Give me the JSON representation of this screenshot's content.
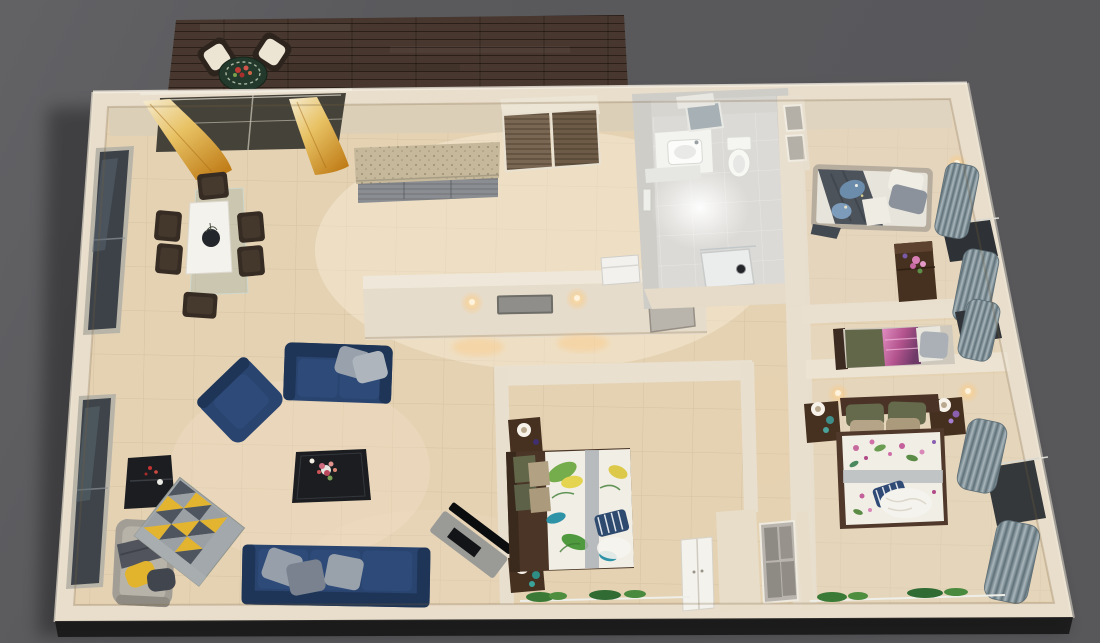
{
  "scene": {
    "description": "Photorealistic 3D rendered top-down floor plan (dollhouse view) of a furnished apartment on a dark gray backdrop",
    "view": "top-down 3D render, slight perspective",
    "rooms": [
      {
        "id": "balcony",
        "label": "Balcony deck",
        "items": [
          "dark wood plank decking",
          "round bistro table with red flowers",
          "two rattan chairs with white cushions"
        ]
      },
      {
        "id": "living-dining",
        "label": "Open living and dining room",
        "items": [
          "glass dining table with white marble runner",
          "six dark dining chairs",
          "navy armchair",
          "navy loveseat with two gray pillows",
          "navy three-seat sofa with three gray pillows",
          "black coffee table with flower bouquet",
          "black console table",
          "gray chaise lounge with yellow and charcoal pillows",
          "geometric triangle rug in gray, charcoal and yellow",
          "angled TV unit with flat-screen TV",
          "amber curtains on balcony sliding door",
          "two tall windows on left wall"
        ]
      },
      {
        "id": "kitchen",
        "label": "Kitchenette",
        "items": [
          "granite countertop with gray cabinet fronts",
          "built-in wardrobe with wood sliding doors",
          "white fridge"
        ]
      },
      {
        "id": "hallway",
        "label": "Hallway",
        "items": [
          "divider wall with two lit sconces",
          "framed picture",
          "gray wall panel"
        ]
      },
      {
        "id": "bathroom",
        "label": "Bathroom",
        "items": [
          "vanity with basin and tilted mirror",
          "toilet",
          "shower tray with drain",
          "white-gray tiles",
          "ceiling light glow"
        ]
      },
      {
        "id": "bedroom-top-right",
        "label": "Bedroom (top right)",
        "items": [
          "single bed with charcoal throw and blue floral duvet",
          "white and gray pillows",
          "dark wood dresser with pink flowers",
          "wall lamp",
          "gray drape curtains and window"
        ]
      },
      {
        "id": "bedroom-middle-right",
        "label": "Bedroom (middle right)",
        "items": [
          "single bed with olive blanket and magenta print throw",
          "gray pillow",
          "gray drape curtain",
          "wall lamp"
        ]
      },
      {
        "id": "master-bedroom",
        "label": "Master bedroom (bottom right)",
        "items": [
          "double bed with floral duvet",
          "olive and tan pillows",
          "navy striped cushion",
          "white knit throw",
          "two dark wood nightstands with lamps",
          "two lit wall sconces",
          "gray drape curtains and window",
          "glass shelf with plants"
        ]
      },
      {
        "id": "bedroom-bottom-middle",
        "label": "Bedroom (bottom middle)",
        "items": [
          "double bed with tropical leaf duvet",
          "olive and tan pillows",
          "navy striped cushion",
          "two dark wood nightstands with lamps",
          "glass shelf with plants"
        ]
      },
      {
        "id": "closet-nook",
        "label": "Closet nook",
        "items": [
          "white double-door wardrobe",
          "gray paneled closet front"
        ]
      }
    ],
    "palette": {
      "background": "#59595c",
      "deck_wood": "#47372e",
      "wall_cream": "#e9decc",
      "wall_face": "#dbcfb8",
      "floor_beige": "#e4d2b3",
      "bath_tile": "#dbdad6",
      "sofa_navy": "#2a4470",
      "sofa_navy_dark": "#1e3557",
      "cushion_navy": "#2d4a79",
      "pillow_gray": "#97a0aa",
      "rug_yellow": "#e2b42f",
      "rug_charcoal": "#4e555e",
      "rug_gray": "#a2a8ab",
      "furniture_black": "#1b1d20",
      "chaise_gray": "#a29e95",
      "wood_dark": "#46301f",
      "bed_white": "#f1eee5",
      "olive_green": "#62674a",
      "tan_pillow": "#b3a184",
      "tropical_green": "#76ad4c",
      "teal_leaf": "#2f93a8",
      "pink_blanket": "#c7699f",
      "blanket_charcoal": "#4d535b",
      "blue_floral": "#6b8cab",
      "granite": "#c6b89b",
      "cabinet_gray": "#8a8d92",
      "door_wood": "#7a6753",
      "glow_warm": "#ffd9a0"
    }
  }
}
